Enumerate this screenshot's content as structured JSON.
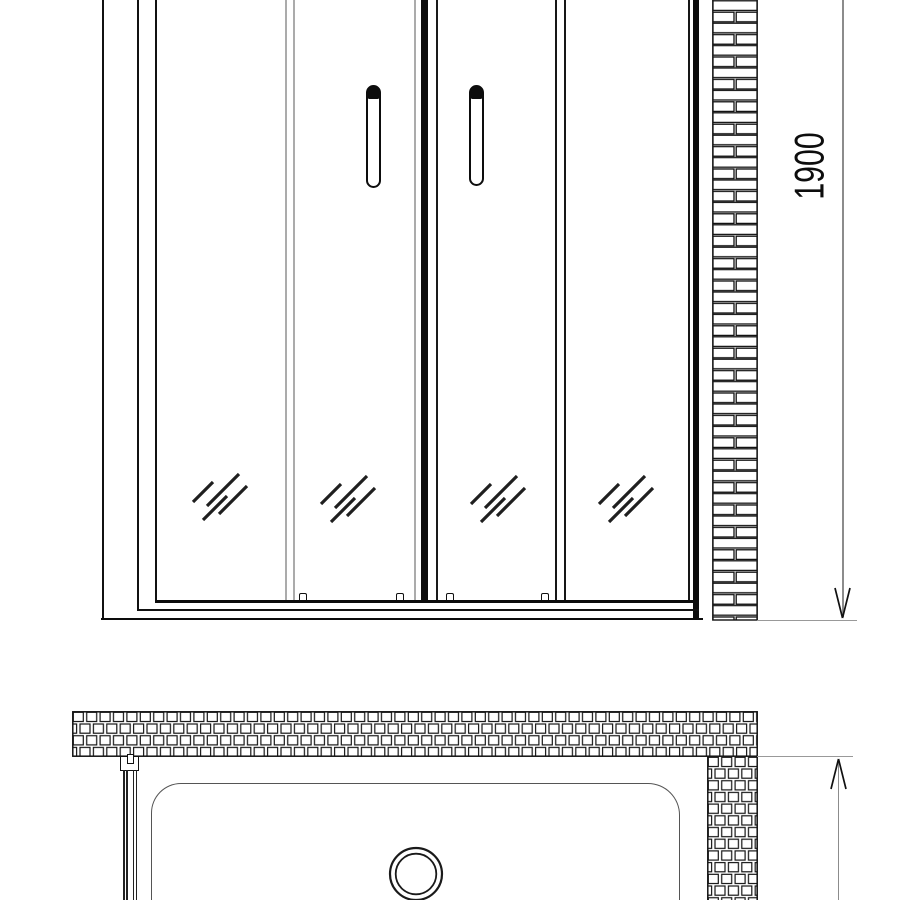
{
  "drawing": {
    "height_dimension_label": "1900",
    "colors": {
      "ink": "#111111",
      "soft_gray": "#ababab",
      "dimension_gray": "#8c8c8c",
      "tray_gray": "#555555"
    }
  }
}
